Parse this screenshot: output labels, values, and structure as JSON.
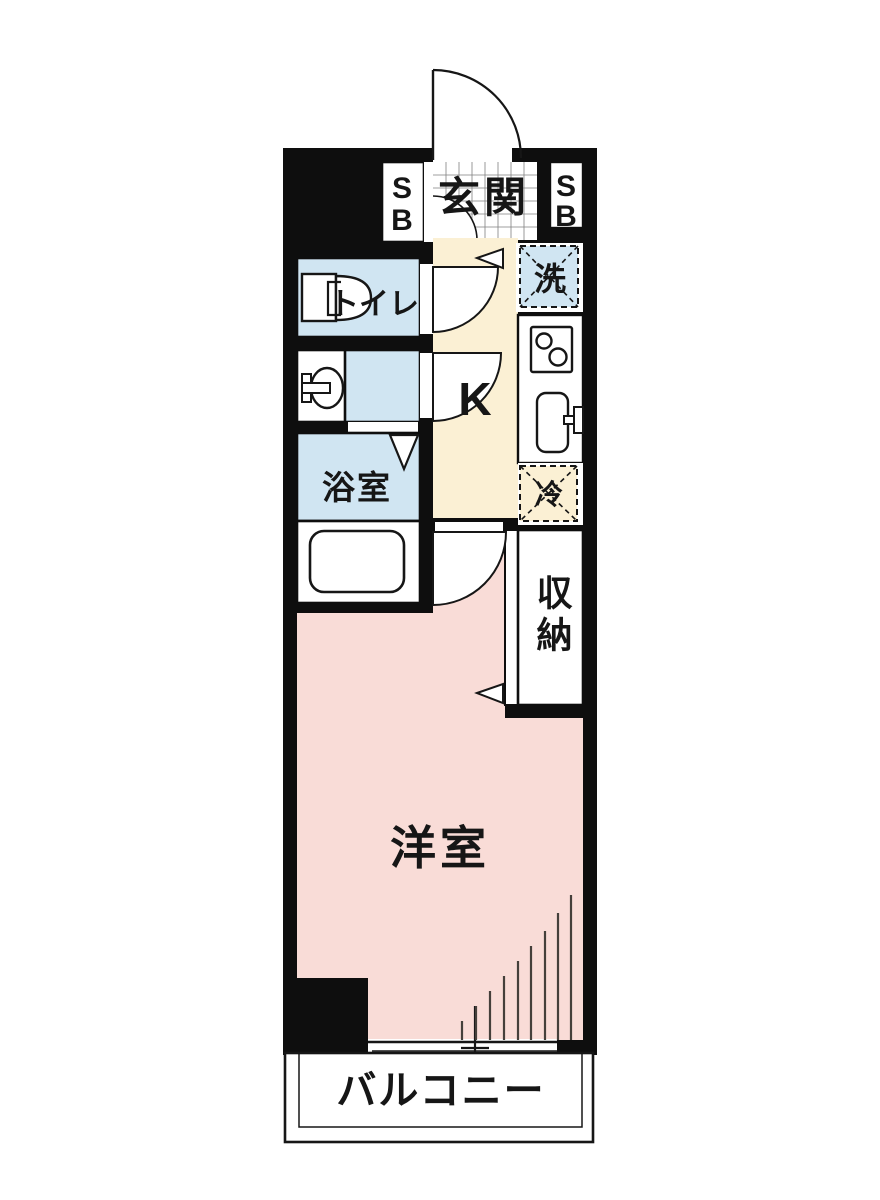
{
  "diagram_type": "apartment-floor-plan",
  "labels": {
    "entrance": "玄関",
    "shoe_box_s": "S",
    "shoe_box_b": "B",
    "washing_machine": "洗",
    "toilet": "トイレ",
    "kitchen": "K",
    "refrigerator": "冷",
    "bathroom": "浴室",
    "storage": "収納",
    "western_room": "洋室",
    "balcony": "バルコニー"
  },
  "colors": {
    "wall": "#0e0e0e",
    "western_room_fill": "#f9dcd7",
    "hallway_fill": "#fbf0d4",
    "wet_area_fill": "#d0e5f2",
    "floor_white": "#ffffff",
    "label_text": "#161616"
  },
  "icons": {
    "toilet-icon": "tank with D-shaped bowl",
    "washbasin-icon": "oval basin with T faucet",
    "stove-icon": "square with two burner circles",
    "kitchen-sink-icon": "rounded rectangle with faucet",
    "bathtub-icon": "rounded rectangle tub",
    "washing-machine-box": "dashed square with X",
    "refrigerator-box": "dashed square with X",
    "door-swing-icon": "quarter-circle arc",
    "window-hatch-icon": "ascending vertical tick lines"
  }
}
